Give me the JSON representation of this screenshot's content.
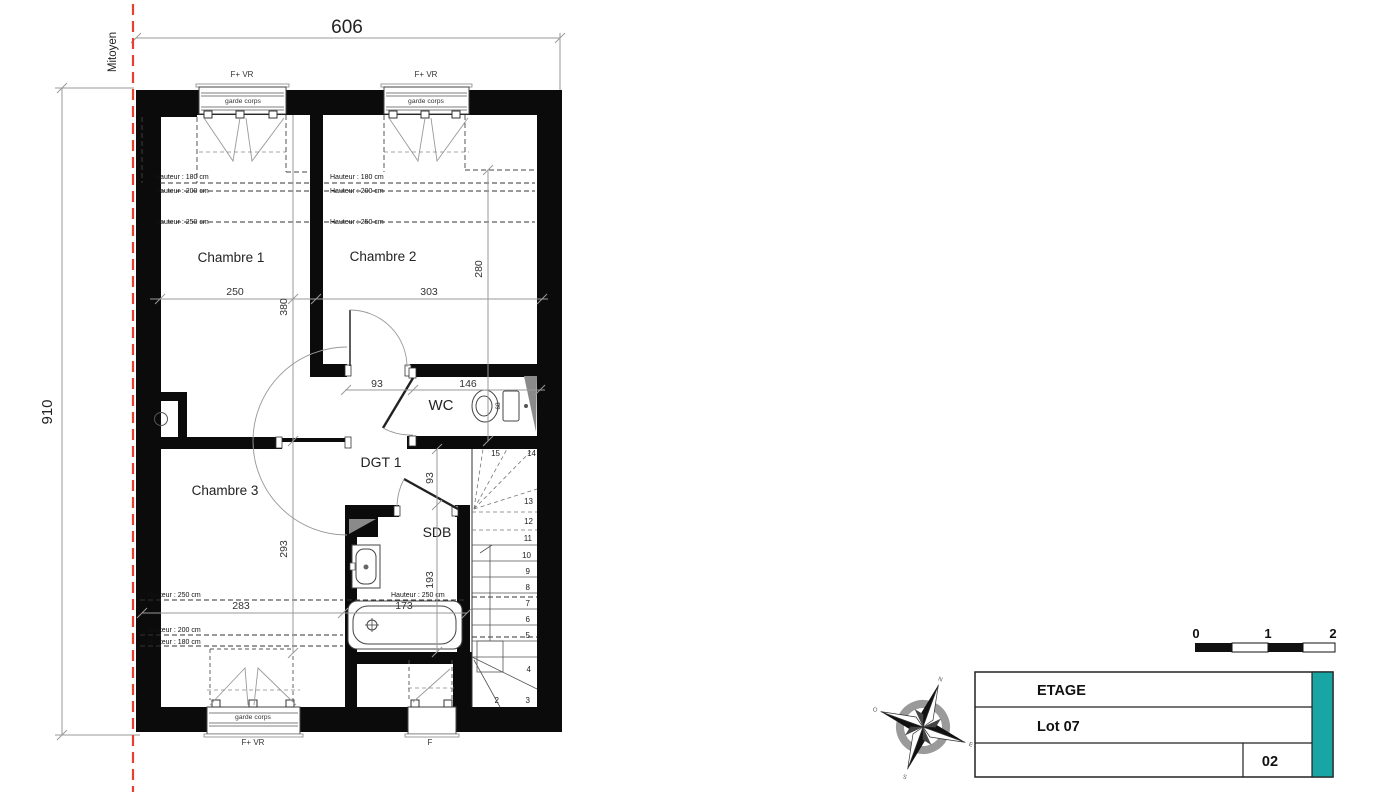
{
  "annotations": {
    "mitoyen": "Mitoyen",
    "garde_corps": "garde corps",
    "f_vr": "F+ VR",
    "f": "F",
    "hauteur_180": "Hauteur : 180 cm",
    "hauteur_200": "Hauteur : 200 cm",
    "hauteur_250": "Hauteur : 250 cm"
  },
  "rooms": {
    "ch1": "Chambre 1",
    "ch2": "Chambre 2",
    "ch3": "Chambre 3",
    "wc": "WC",
    "dgt": "DGT 1",
    "sdb": "SDB"
  },
  "dims": {
    "total_width": "606",
    "total_height": "910",
    "ch1_width": "250",
    "ch2_width": "303",
    "ch2_height": "280",
    "ch1_height": "380",
    "wc_door": "93",
    "wc_width": "146",
    "wc_depth": "68",
    "dgt_width": "93",
    "ch3_height": "293",
    "ch3_width": "283",
    "sdb_height": "193",
    "bath_width": "173"
  },
  "stairs": {
    "steps": [
      "2",
      "3",
      "4",
      "5",
      "6",
      "7",
      "8",
      "9",
      "10",
      "11",
      "12",
      "13",
      "14",
      "15"
    ]
  },
  "scale_bar": {
    "labels": [
      "0",
      "1",
      "2"
    ]
  },
  "title_block": {
    "line1": "ETAGE",
    "line2": "Lot 07",
    "number": "02",
    "accent_color": "#1aa5a5"
  },
  "compass": {
    "letters": [
      "N",
      "E",
      "S",
      "O"
    ]
  },
  "colors": {
    "party_wall": "#e8402c",
    "wall": "#0b0b0b",
    "dim_line": "#9a9a9a"
  }
}
